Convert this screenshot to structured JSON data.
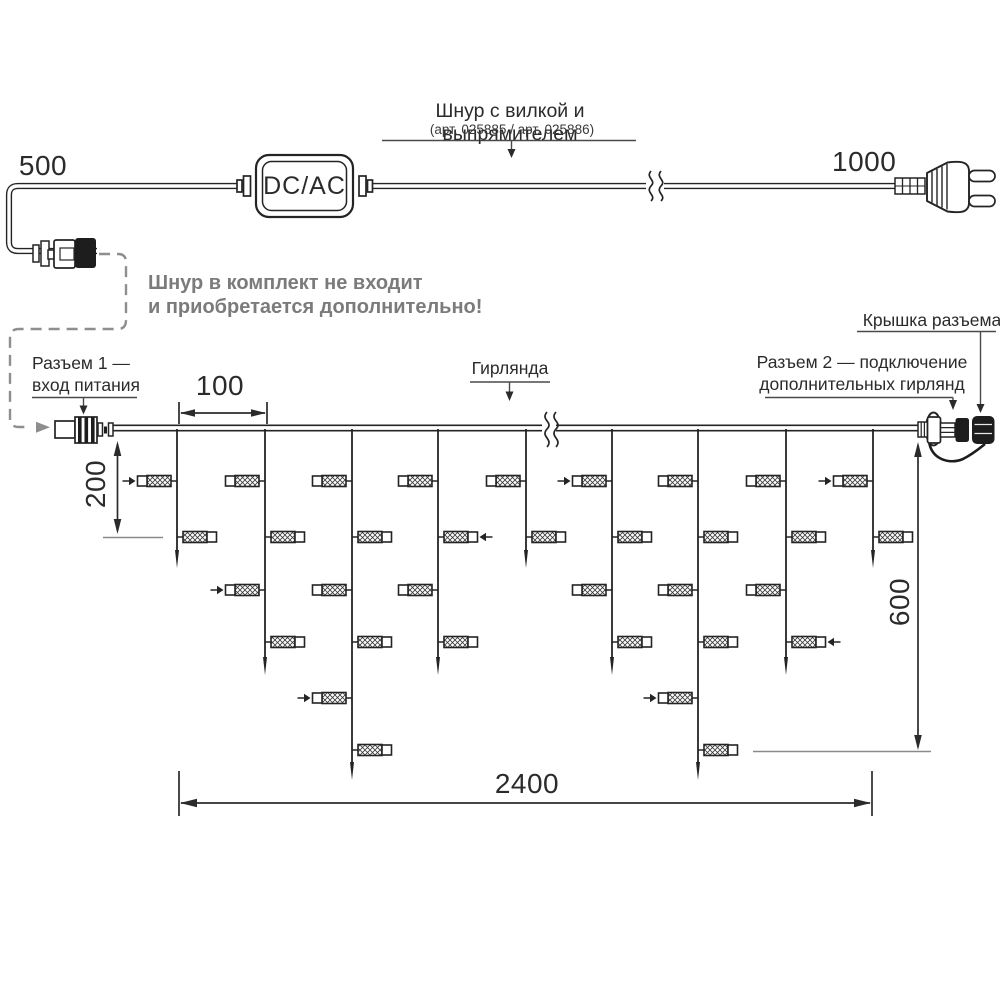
{
  "power_section": {
    "title": "Шнур с вилкой и выпрямителем",
    "subtitle": "(арт. 025885 / арт. 025886)",
    "adapter_label": "DC/AC",
    "dim_cord_left": "500",
    "dim_cord_right": "1000",
    "note_line1": "Шнур в комплект не входит",
    "note_line2": "и приобретается дополнительно!"
  },
  "garland_section": {
    "connector1_line1": "Разъем 1 —",
    "connector1_line2": "вход питания",
    "garland_label": "Гирлянда",
    "cap_label": "Крышка разъема",
    "connector2_line1": "Разъем 2 — подключение",
    "connector2_line2": "дополнительных гирлянд",
    "dim_spacing": "100",
    "dim_first_drop": "200",
    "dim_drop_max": "600",
    "dim_total": "2400"
  },
  "colors": {
    "line": "#242424",
    "dashed_gray": "#8e8e8e",
    "note_gray": "#7b7b7b",
    "ref_gray": "#8a8a8a"
  },
  "diagram": {
    "wire_y": 428,
    "wire_x_start": 112,
    "wire_x_end": 918,
    "break_x": 549,
    "lamp_rows_y": [
      481,
      537,
      590,
      642,
      698,
      750
    ],
    "drops": [
      {
        "x": 177,
        "tip": 568,
        "lamps": [
          {
            "row": 0,
            "side": "left",
            "flash": true
          },
          {
            "row": 1,
            "side": "right"
          }
        ]
      },
      {
        "x": 265,
        "tip": 675,
        "lamps": [
          {
            "row": 0,
            "side": "left"
          },
          {
            "row": 1,
            "side": "right"
          },
          {
            "row": 2,
            "side": "left",
            "flash": true
          },
          {
            "row": 3,
            "side": "right"
          }
        ]
      },
      {
        "x": 352,
        "tip": 780,
        "lamps": [
          {
            "row": 0,
            "side": "left"
          },
          {
            "row": 1,
            "side": "right"
          },
          {
            "row": 2,
            "side": "left"
          },
          {
            "row": 3,
            "side": "right"
          },
          {
            "row": 4,
            "side": "left",
            "flash": true
          },
          {
            "row": 5,
            "side": "right"
          }
        ]
      },
      {
        "x": 438,
        "tip": 675,
        "lamps": [
          {
            "row": 0,
            "side": "left"
          },
          {
            "row": 1,
            "side": "right",
            "flash": true
          },
          {
            "row": 2,
            "side": "left"
          },
          {
            "row": 3,
            "side": "right"
          }
        ]
      },
      {
        "x": 526,
        "tip": 568,
        "lamps": [
          {
            "row": 0,
            "side": "left"
          },
          {
            "row": 1,
            "side": "right"
          }
        ]
      },
      {
        "x": 612,
        "tip": 675,
        "lamps": [
          {
            "row": 0,
            "side": "left",
            "flash": true
          },
          {
            "row": 1,
            "side": "right"
          },
          {
            "row": 2,
            "side": "left"
          },
          {
            "row": 3,
            "side": "right"
          }
        ]
      },
      {
        "x": 698,
        "tip": 780,
        "lamps": [
          {
            "row": 0,
            "side": "left"
          },
          {
            "row": 1,
            "side": "right"
          },
          {
            "row": 2,
            "side": "left"
          },
          {
            "row": 3,
            "side": "right"
          },
          {
            "row": 4,
            "side": "left",
            "flash": true
          },
          {
            "row": 5,
            "side": "right"
          }
        ]
      },
      {
        "x": 786,
        "tip": 675,
        "lamps": [
          {
            "row": 0,
            "side": "left"
          },
          {
            "row": 1,
            "side": "right"
          },
          {
            "row": 2,
            "side": "left"
          },
          {
            "row": 3,
            "side": "right",
            "flash": true
          }
        ]
      },
      {
        "x": 873,
        "tip": 568,
        "lamps": [
          {
            "row": 0,
            "side": "left",
            "flash": true
          },
          {
            "row": 1,
            "side": "right"
          }
        ]
      }
    ]
  }
}
